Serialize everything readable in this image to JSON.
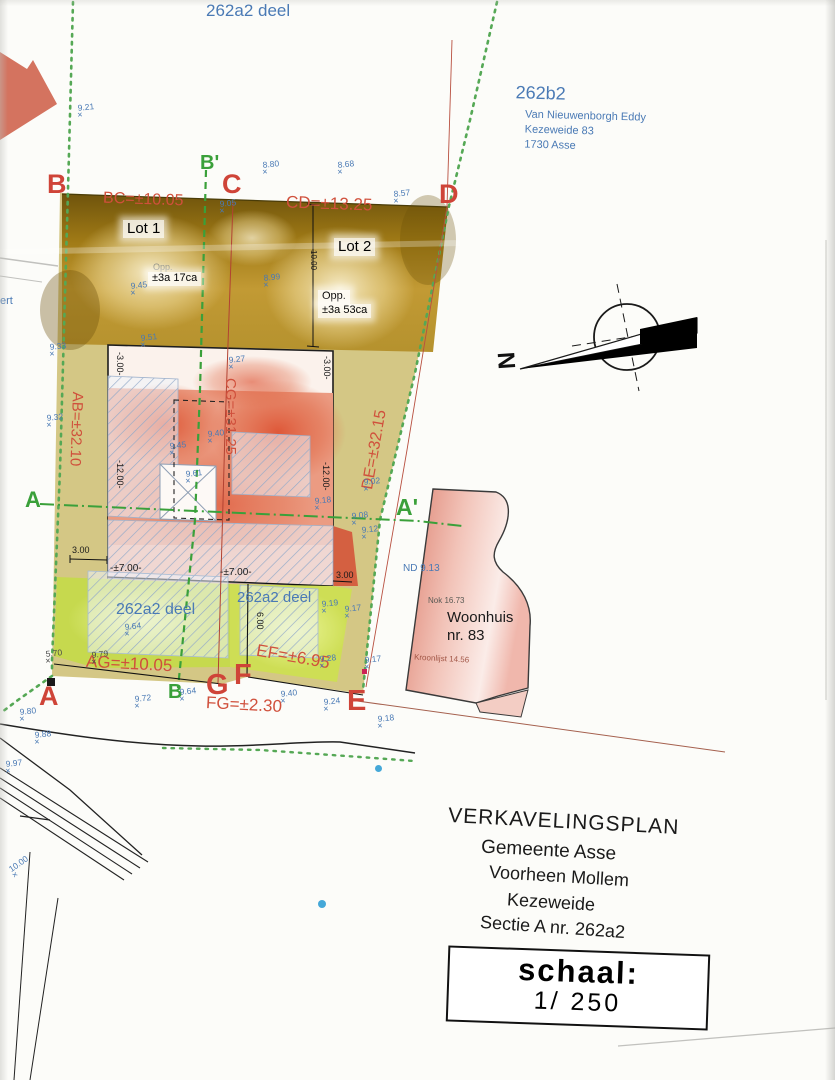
{
  "page": {
    "top_parcel_label": "262a2 deel",
    "left_edge_fragment": "ert",
    "neighbor_block": {
      "parcel_id": "262b2",
      "owner": "Van Nieuwenborgh Eddy",
      "address": "Kezeweide 83",
      "city": "1730 Asse"
    }
  },
  "points": {
    "b_top": "B",
    "b_prime": "B'",
    "c": "C",
    "d": "D",
    "a_left": "A",
    "a_prime": "A'",
    "a_bottom": "A",
    "b_bottom": "B",
    "g": "G",
    "f": "F",
    "e": "E"
  },
  "measurements": {
    "ab": "AB=±32.10",
    "bc": "BC=±10.05",
    "cd": "CD=±13.25",
    "de": "DE=±32.15",
    "ef": "EF=±6.95",
    "fg": "FG=±2.30",
    "ag": "AG=±10.05",
    "cg": "CG=±31.25"
  },
  "lots": {
    "lot1": {
      "name": "Lot 1",
      "opp": "Opp.",
      "area": "±3a 17ca"
    },
    "lot2": {
      "name": "Lot 2",
      "opp": "Opp.",
      "area": "±3a 53ca"
    }
  },
  "front_parcels": {
    "left": "262a2 deel",
    "right": "262a2 deel"
  },
  "dims": {
    "ten": "10.00",
    "minus3_l": "-3.00-",
    "minus3_r": "-3.00-",
    "minus12_l": "-12.00-",
    "minus12_r": "-12.00-",
    "plus7_l": "-±7.00-",
    "plus7_r": "-±7.00-",
    "three_l": "3.00",
    "three_r": "3.00",
    "six": "6.00"
  },
  "house": {
    "nd": "ND 9.13",
    "nok": "Nok 16.73",
    "line1": "Woonhuis",
    "line2": "nr. 83",
    "kroonlijst": "Kroonlijst 14.56"
  },
  "compass": {
    "north": "N"
  },
  "title_block": {
    "line1": "VERKAVELINGSPLAN",
    "line2": "Gemeente Asse",
    "line3": "Voorheen Mollem",
    "line4": "Kezeweide",
    "line5": "Sectie A nr. 262a2"
  },
  "scale_box": {
    "label": "schaal:",
    "value": "1/ 250"
  },
  "marker_glyph": "×",
  "spot_heights": [
    {
      "v": "9.21",
      "x": 78,
      "y": 104
    },
    {
      "v": "8.80",
      "x": 263,
      "y": 161
    },
    {
      "v": "8.68",
      "x": 338,
      "y": 161
    },
    {
      "v": "8.57",
      "x": 394,
      "y": 190
    },
    {
      "v": "9.05",
      "x": 220,
      "y": 200
    },
    {
      "v": "9.45",
      "x": 131,
      "y": 282
    },
    {
      "v": "8.99",
      "x": 264,
      "y": 274
    },
    {
      "v": "9.33",
      "x": 50,
      "y": 343
    },
    {
      "v": "9.51",
      "x": 141,
      "y": 334
    },
    {
      "v": "9.27",
      "x": 229,
      "y": 356
    },
    {
      "v": "9.32",
      "x": 47,
      "y": 414
    },
    {
      "v": "9.45",
      "x": 170,
      "y": 442
    },
    {
      "v": "9.40",
      "x": 208,
      "y": 430
    },
    {
      "v": "9.61",
      "x": 186,
      "y": 470
    },
    {
      "v": "9.02",
      "x": 364,
      "y": 478
    },
    {
      "v": "9.18",
      "x": 315,
      "y": 497
    },
    {
      "v": "9.08",
      "x": 352,
      "y": 512
    },
    {
      "v": "9.12",
      "x": 362,
      "y": 526
    },
    {
      "v": "9.19",
      "x": 322,
      "y": 600
    },
    {
      "v": "9.17",
      "x": 345,
      "y": 605
    },
    {
      "v": "9.64",
      "x": 125,
      "y": 623
    },
    {
      "v": "9.28",
      "x": 320,
      "y": 655
    },
    {
      "v": "9.17",
      "x": 365,
      "y": 656
    },
    {
      "v": "5.70",
      "x": 46,
      "y": 650,
      "c": "dark"
    },
    {
      "v": "9.79",
      "x": 92,
      "y": 651,
      "c": "dark"
    },
    {
      "v": "9.64",
      "x": 180,
      "y": 688
    },
    {
      "v": "9.72",
      "x": 135,
      "y": 695
    },
    {
      "v": "9.40",
      "x": 281,
      "y": 690
    },
    {
      "v": "9.24",
      "x": 324,
      "y": 698
    },
    {
      "v": "9.18",
      "x": 378,
      "y": 715
    },
    {
      "v": "9.80",
      "x": 20,
      "y": 708
    },
    {
      "v": "9.88",
      "x": 35,
      "y": 731
    },
    {
      "v": "9.97",
      "x": 6,
      "y": 760
    },
    {
      "v": "10.00",
      "x": 10,
      "y": 860,
      "rot": -35
    }
  ]
}
